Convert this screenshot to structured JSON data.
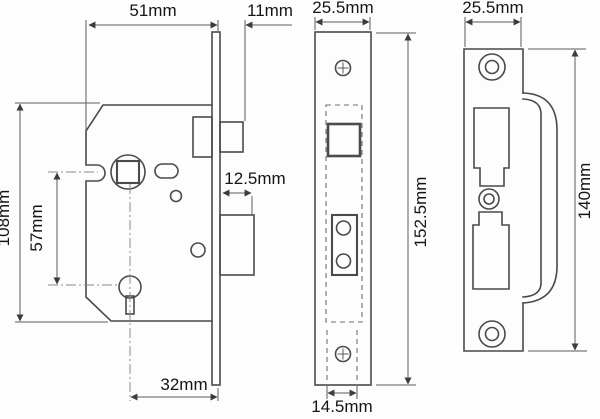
{
  "colors": {
    "background": "#fdfdfd",
    "line": "#4a4a4a",
    "dim_line": "#5a5a5a",
    "center_line": "#8a8a8a",
    "text": "#151515"
  },
  "views": {
    "lock_body": {
      "dim_width": "51mm",
      "dim_latch_projection": "11mm",
      "dim_case_height": "108mm",
      "dim_spindle_to_keyhole": "57mm",
      "dim_deadbolt_throw": "12.5mm",
      "dim_backset": "32mm"
    },
    "faceplate": {
      "dim_width": "25.5mm",
      "dim_height": "152.5mm",
      "dim_case_width": "14.5mm"
    },
    "strike_plate": {
      "dim_width": "25.5mm",
      "dim_height": "140mm"
    }
  }
}
